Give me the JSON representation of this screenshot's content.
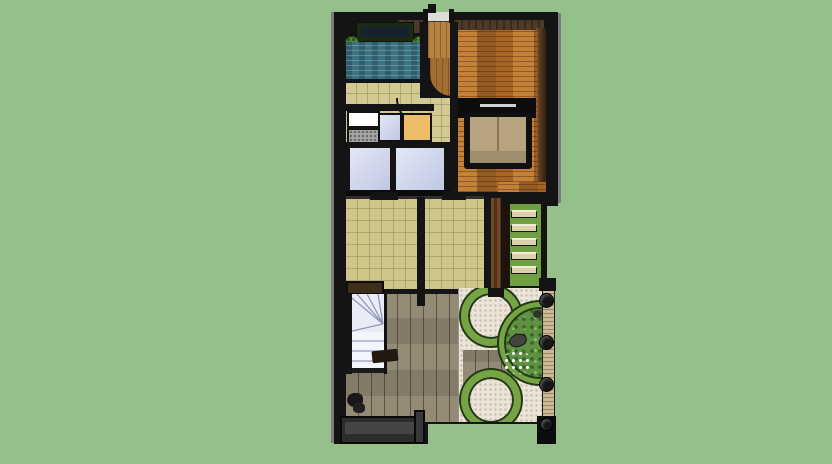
{
  "scene": {
    "description": "Overhead 3D render of a narrow house floor plan with rear garden deck, round gravel patios, garden steps, pool and side fence",
    "view": "top-down orthographic render"
  },
  "colors": {
    "lawn": "#95c089",
    "wall": "#141414",
    "wall_top": "#4e3b27",
    "wood_floor": "#ad6a2a",
    "light_wood": "#b5823f",
    "tile": "#d3ca93",
    "tatami": "#cfc68c",
    "water": "#3c7383",
    "glass": "#ccd4ee",
    "deck": "#8e8570",
    "gravel": "#ebe4d7",
    "garden_ring": "#76a445",
    "foliage": "#5f9142",
    "grass_steps": "#6f9f41",
    "tread": "#dcd1ab",
    "fence": "#c9ba93",
    "sofa": "#b5a47e",
    "counter_orange": "#eebd6a",
    "sink_white": "#ffffff",
    "stove_gray": "#a3a3a3",
    "stair_steps": "#e9ebf7",
    "bench_green": "#1b2b15",
    "bush": "#55823a",
    "platform": "#2c2c2c"
  },
  "regions": {
    "viewport": {
      "label": "3D model viewport"
    },
    "pool": {
      "label": "Water feature / plunge pool"
    },
    "bench": {
      "label": "Green bench planter"
    },
    "living": {
      "label": "Wood-floor living room"
    },
    "sofa": {
      "label": "Sofa with console table"
    },
    "kitchen": {
      "label": "Kitchen counters"
    },
    "hall": {
      "label": "Tiled hallway"
    },
    "glass": {
      "label": "Glass roof panels"
    },
    "room_a": {
      "label": "Tiled room A"
    },
    "room_b": {
      "label": "Tiled room B"
    },
    "deck": {
      "label": "Timber deck courtyard"
    },
    "stair_interior": {
      "label": "Interior winder staircase"
    },
    "stair_garden": {
      "label": "Grass garden steps"
    },
    "patio_a": {
      "label": "Round gravel patio (upper)"
    },
    "patio_b": {
      "label": "Round gravel patio (lower)"
    },
    "planting": {
      "label": "Shrub planting bed"
    },
    "fence": {
      "label": "Side fence with posts"
    },
    "platform": {
      "label": "Entry platform step"
    },
    "door": {
      "label": "Top entry door"
    }
  }
}
